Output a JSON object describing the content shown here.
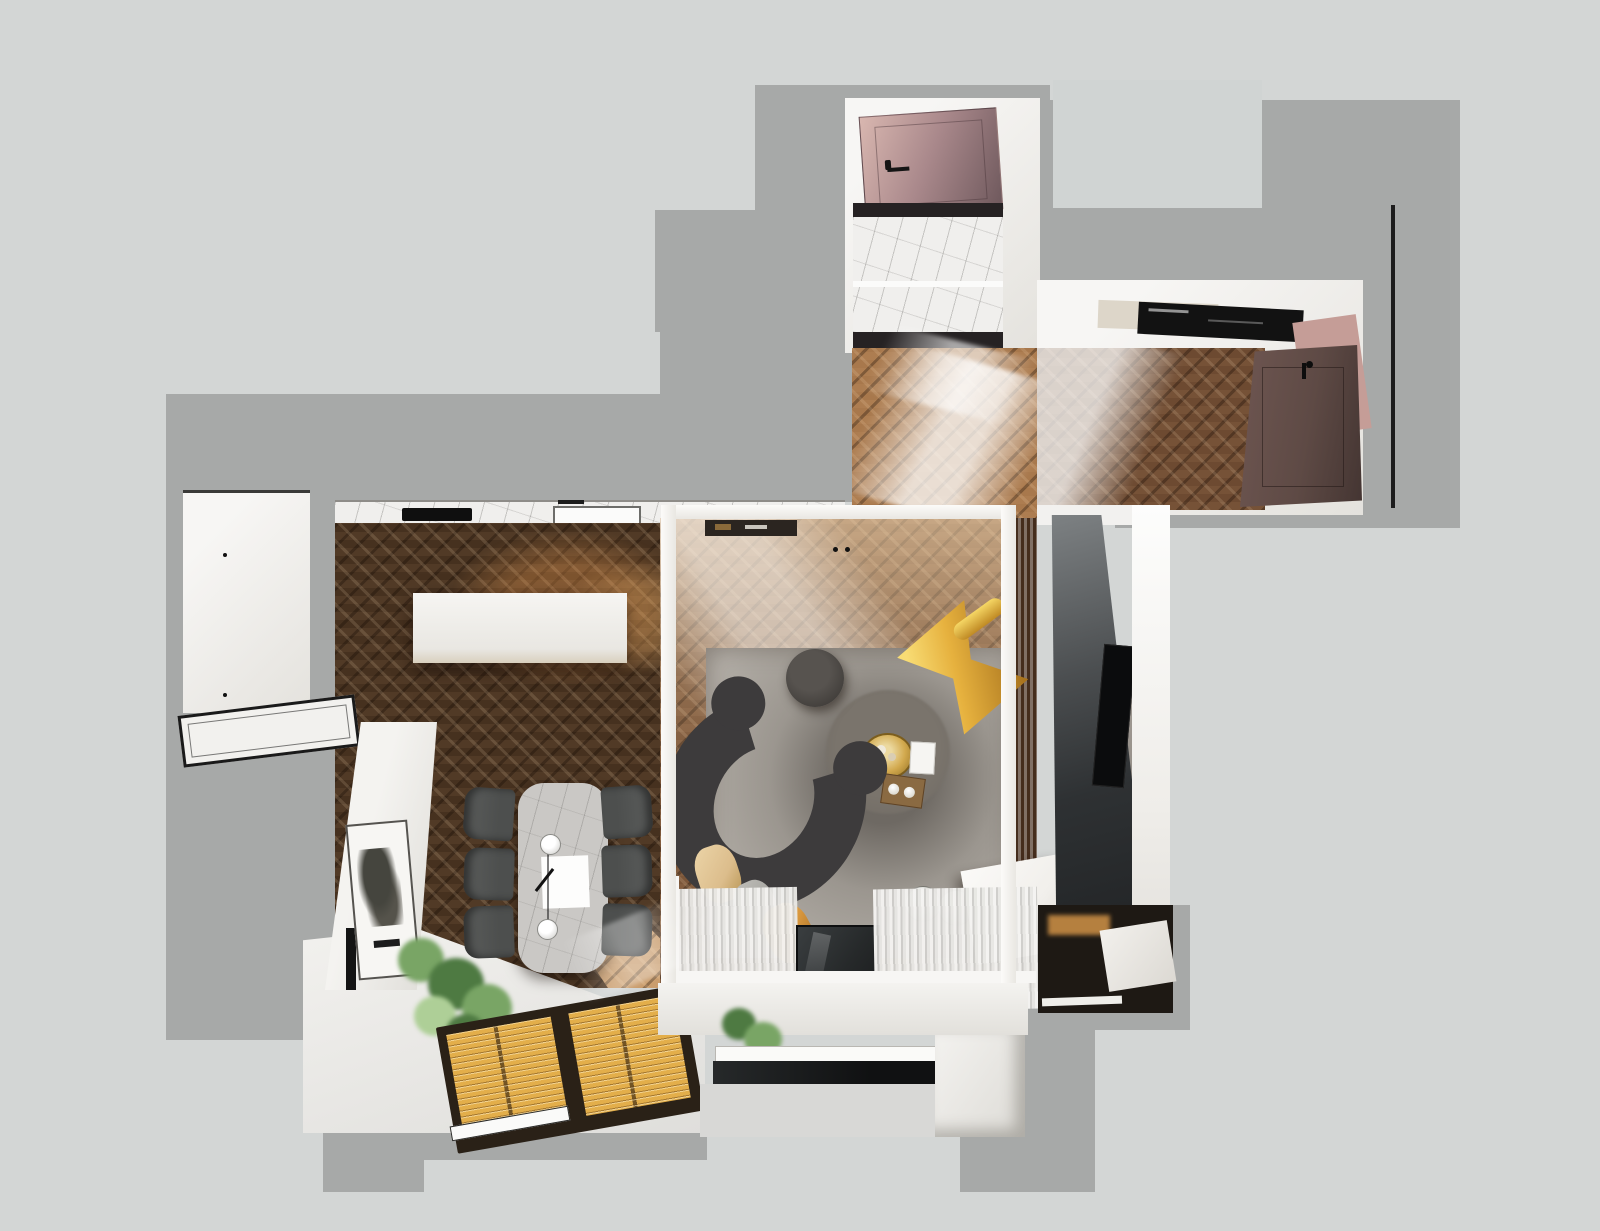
{
  "scene": {
    "title": "Top-down 3D render of an apartment floor plan",
    "view": "dollhouse-top-view",
    "rooms": [
      {
        "id": "bathroom",
        "label": "Bathroom with marble floor"
      },
      {
        "id": "entry-hall",
        "label": "Entry hall"
      },
      {
        "id": "hallway-wardrobe",
        "label": "Hallway with wardrobe and entrance door"
      },
      {
        "id": "kitchen",
        "label": "Kitchen"
      },
      {
        "id": "dining-area",
        "label": "Dining area"
      },
      {
        "id": "living-room",
        "label": "Living room behind glass partition"
      },
      {
        "id": "balcony",
        "label": "Balcony / loggia"
      }
    ],
    "furniture": [
      {
        "id": "bathroom-door",
        "label": "Mauve bathroom door"
      },
      {
        "id": "entrance-door",
        "label": "Dark brown entrance door"
      },
      {
        "id": "wardrobe-shelf",
        "label": "Wardrobe shelf with black storage"
      },
      {
        "id": "kitchen-counter",
        "label": "Marble kitchen counter"
      },
      {
        "id": "cooktop",
        "label": "Black cooktop"
      },
      {
        "id": "sink",
        "label": "Kitchen sink with faucet"
      },
      {
        "id": "kitchen-island",
        "label": "White kitchen island"
      },
      {
        "id": "glass-counter",
        "label": "Glass-top counter"
      },
      {
        "id": "wall-art",
        "label": "Framed abstract artwork"
      },
      {
        "id": "dining-table",
        "label": "Marble dining table"
      },
      {
        "id": "dining-chairs",
        "label": "Six dark dining chairs"
      },
      {
        "id": "pendant-lamp",
        "label": "Twin pendant lamp over table"
      },
      {
        "id": "window-blinds",
        "label": "Amber wooden window blinds"
      },
      {
        "id": "plant",
        "label": "Green potted plant"
      },
      {
        "id": "rug",
        "label": "Large gray area rug"
      },
      {
        "id": "round-rug",
        "label": "Round dark rug"
      },
      {
        "id": "curved-sofa",
        "label": "Curved charcoal sofa with cushions"
      },
      {
        "id": "ottoman",
        "label": "Round dark ottoman"
      },
      {
        "id": "gold-tray-table",
        "label": "Gold tray coffee table"
      },
      {
        "id": "lounge-chair",
        "label": "Yellow butterfly lounge chair"
      },
      {
        "id": "glass-pendants",
        "label": "Two glass globe lamps"
      },
      {
        "id": "media-console",
        "label": "White media console"
      },
      {
        "id": "tv-panel",
        "label": "Dark TV feature wall"
      },
      {
        "id": "tv",
        "label": "Wall-mounted TV"
      },
      {
        "id": "tv-cabinet",
        "label": "TV cabinet with white drawer"
      },
      {
        "id": "curtains",
        "label": "Sheer white curtains"
      },
      {
        "id": "sliding-glass-door",
        "label": "Dark glass balcony door"
      }
    ]
  },
  "colors": {
    "bg": "#d3d6d5",
    "wall": "#a7a9a8",
    "wall-light": "#d0d4d3",
    "white": "#f7f6f4",
    "white-dim": "#e4e2dd",
    "wood-dark": "#46311f",
    "wood-mid": "#74513a",
    "wood-light": "#c79a6a",
    "marble": "#f0efed",
    "marble-dark": "#262223",
    "rug": "#b2ada6",
    "rug-dark": "#6e6963",
    "sofa": "#3d3b3c",
    "pillow-tan": "#dcbd8c",
    "pillow-gray": "#a8a7a2",
    "pillow-amber": "#d9983f",
    "gold": "#d2a94e",
    "chair-yellow": "#e6b13e",
    "dining-chair": "#4d4f4e",
    "table-marble": "#cac8c5",
    "blind-amber": "#e3ae4a",
    "blind-frame": "#2a2117",
    "green": "#79a565",
    "green-dark": "#4e7a42",
    "green-light": "#aecf97",
    "door-mauve": "#a9888b",
    "door-brown": "#5e4a45",
    "tv-panel": "#2e3133",
    "glass-dark": "#26292a",
    "curtain": "#e9e8e5",
    "console-white": "#f1efeb"
  }
}
